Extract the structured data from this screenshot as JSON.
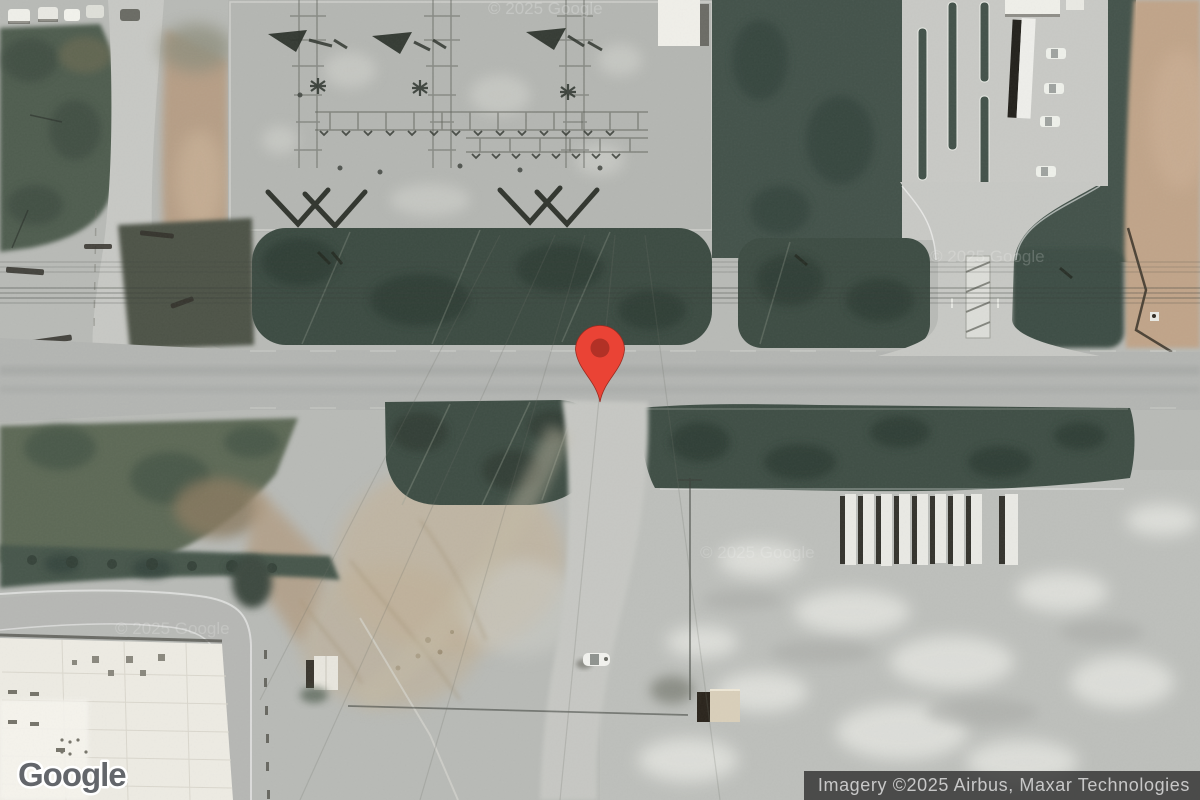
{
  "branding": {
    "logo_text": "Google"
  },
  "attribution": {
    "text": "Imagery ©2025 Airbus, Maxar Technologies"
  },
  "watermark": {
    "text": "© 2025 Google"
  },
  "marker": {
    "fill": "#EA4335",
    "dot": "#B23126"
  },
  "palette": {
    "terrain_base": "#b8bab6",
    "substation_pad": "#b4b6b2",
    "grass": "#4e5c50",
    "hedge_dark_green": "#3c4b42",
    "road": "#b3b5b2",
    "dirt_tan": "#bfa287",
    "warehouse_roof": "#edebe3",
    "attribution_bg": "#2a2a2a",
    "attribution_text": "#c8c8c8"
  }
}
